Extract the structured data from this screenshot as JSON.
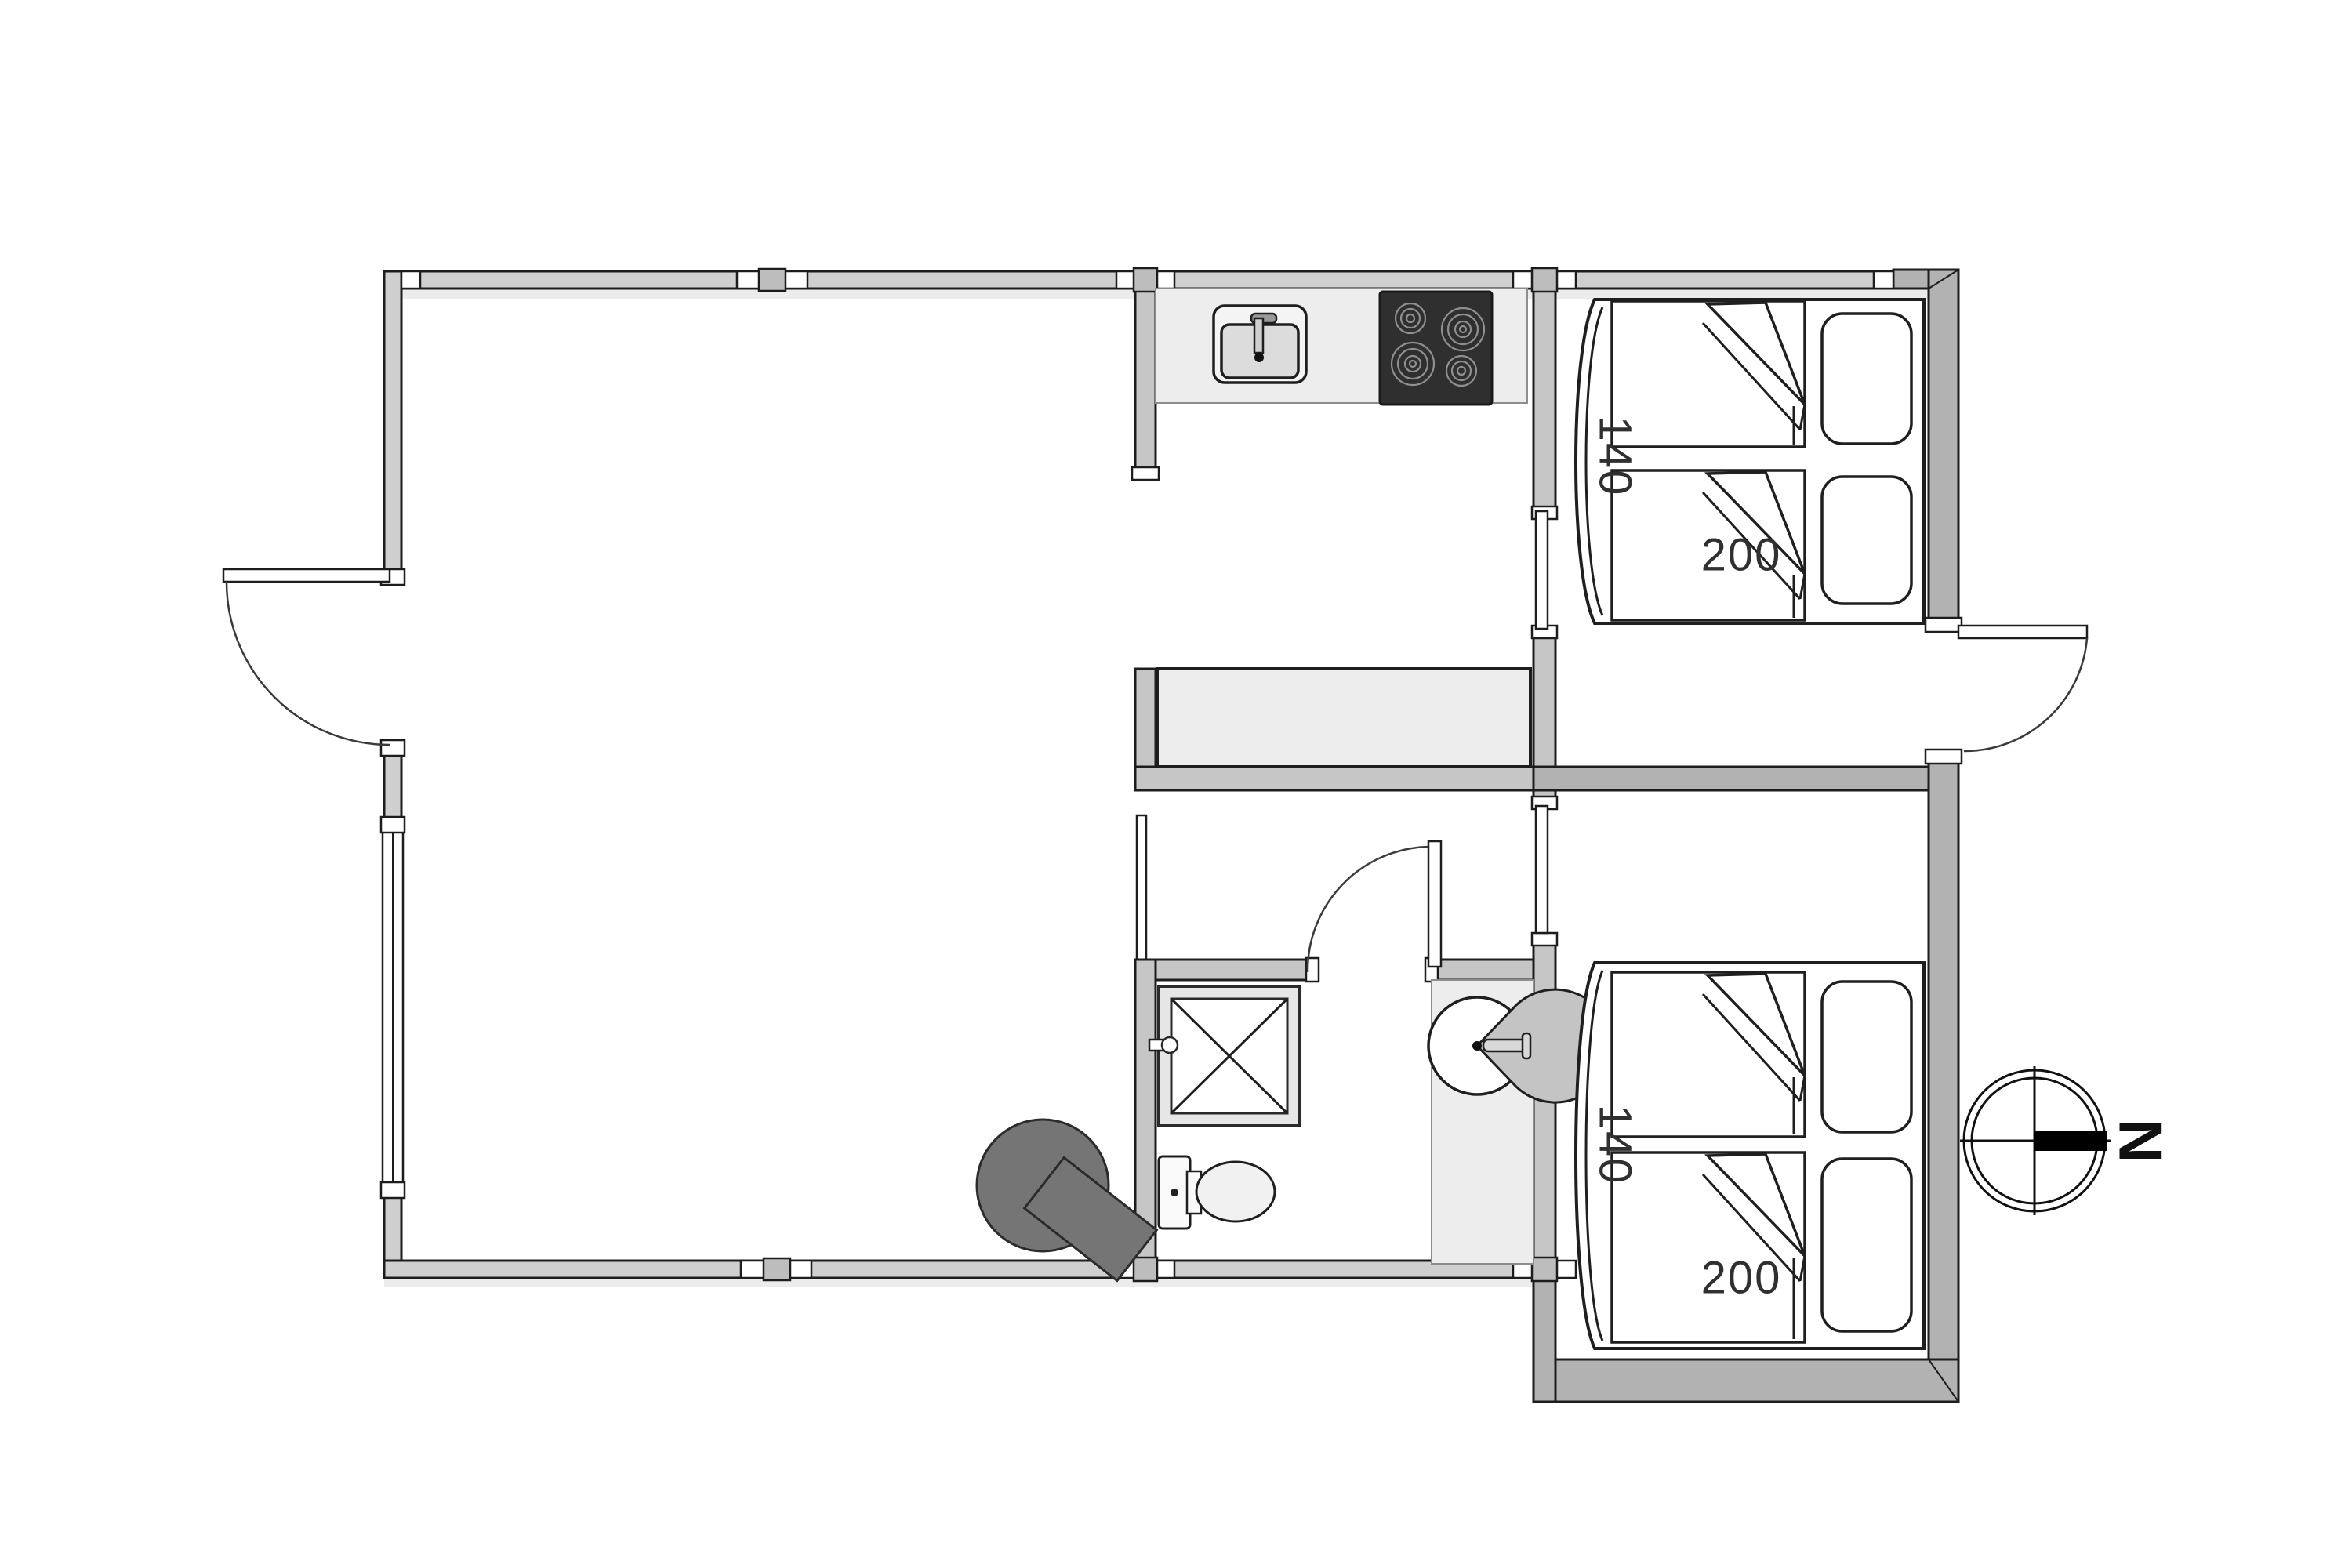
{
  "floor_plan": {
    "bedroom_top": {
      "bed_width_label": "140",
      "bed_length_label": "200"
    },
    "bedroom_bottom": {
      "bed_width_label": "140",
      "bed_length_label": "200"
    },
    "compass": {
      "north_label": "N"
    },
    "colors": {
      "wall_fill": "#c6c6c6",
      "thick_wall_fill": "#b2b2b2",
      "fixture_fill": "#ededed",
      "cooktop_fill": "#2f2f2f",
      "wood_stove_fill": "#757575",
      "line": "#1d1d1d"
    }
  }
}
